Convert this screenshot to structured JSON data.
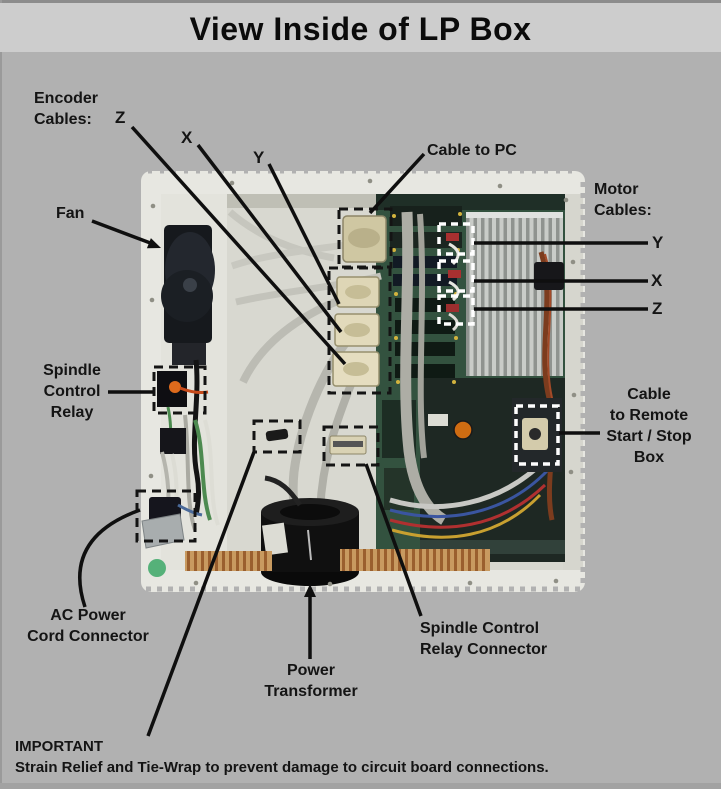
{
  "title": "View Inside of LP Box",
  "labels": {
    "encoder_cables": "Encoder\nCables:",
    "encoder_z": "Z",
    "encoder_x": "X",
    "encoder_y": "Y",
    "cable_to_pc": "Cable to PC",
    "fan": "Fan",
    "motor_cables": "Motor\nCables:",
    "motor_y": "Y",
    "motor_x": "X",
    "motor_z": "Z",
    "spindle_control_relay": "Spindle\nControl\nRelay",
    "cable_to_remote": "Cable\nto Remote\nStart / Stop\nBox",
    "ac_power_cord": "AC Power\nCord Connector",
    "power_transformer": "Power\nTransformer",
    "spindle_relay_connector": "Spindle Control\nRelay Connector",
    "important_title": "IMPORTANT",
    "important_text": "Strain Relief and Tie-Wrap to prevent damage to circuit board connections."
  },
  "colors": {
    "page_background": "#b1b1b1",
    "title_band": "#cdcdcd",
    "callout_line": "#0f0f0f",
    "highlight_dash_dark": "#141414",
    "highlight_dash_light": "#ffffff",
    "enclosure_white": "#e7e7e1",
    "pcb_green": "#33523f",
    "green_indicator": "#55b179"
  }
}
